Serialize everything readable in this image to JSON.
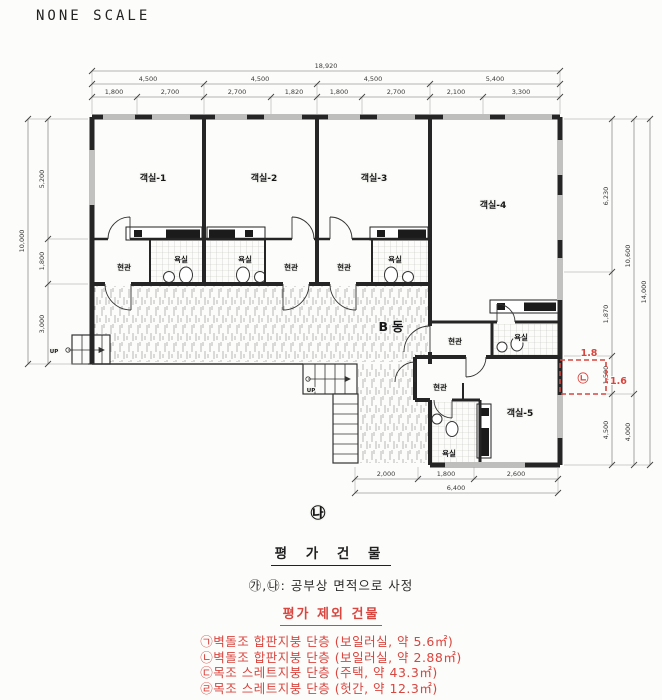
{
  "meta": {
    "scale_label": "NONE SCALE",
    "building_label": "B동",
    "plan_marker": "㉯",
    "up_label": "UP",
    "accent_red": "#d9453f",
    "line_color": "#252525"
  },
  "labels": {
    "rooms": [
      "객실-1",
      "객실-2",
      "객실-3",
      "객실-4",
      "객실-5"
    ],
    "entrance": "현관",
    "bath": "욕실"
  },
  "dims": {
    "top_total": "18,920",
    "top_spans": [
      "4,500",
      "4,500",
      "4,500",
      "5,400"
    ],
    "top_sub": [
      "1,800",
      "2,700",
      "2,700",
      "1,820",
      "1,800",
      "2,700",
      "2,100",
      "3,300"
    ],
    "left": [
      "5,200",
      "1,800",
      "3,000"
    ],
    "left_total": "10,000",
    "right": [
      "6,230",
      "1,870",
      "1,500",
      "4,500"
    ],
    "right_mid": [
      "10,600",
      "4,000"
    ],
    "right_total": "14,000",
    "bottom": [
      "2,000",
      "1,800",
      "2,600"
    ],
    "bottom_total": "6,400"
  },
  "annotation": {
    "width_m": "1.8",
    "height_m": "1.6",
    "symbol": "㉡"
  },
  "notes": {
    "title": "평 가 건 물",
    "subtitle": "㉮,㉯: 공부상 면적으로 사정",
    "excluded_title": "평가 제외 건물",
    "excluded_items": [
      "㉠벽돌조 합판지붕 단층 (보일러실, 약 5.6㎡)",
      "㉡벽돌조 합판지붕 단층 (보일러실, 약 2.88㎡)",
      "㉢목조 스레트지붕 단층 (주택, 약 43.3㎡)",
      "㉣목조 스레트지붕 단층 (헛간, 약 12.3㎡)"
    ]
  }
}
